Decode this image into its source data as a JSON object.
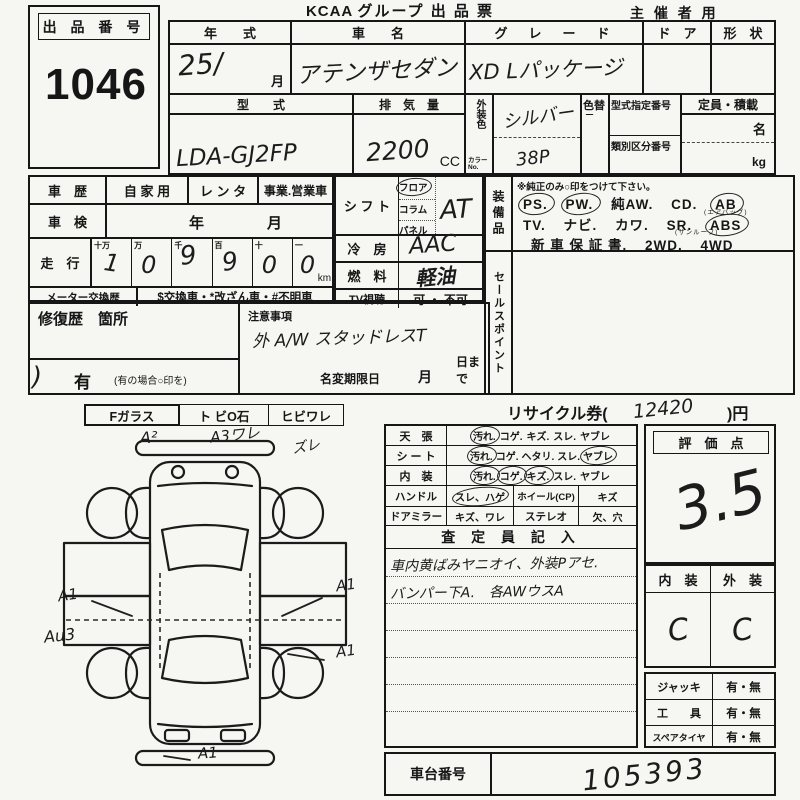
{
  "page": {
    "brand": "KCAA",
    "title": "グループ 出 品 票",
    "organizer": "主 催 者 用"
  },
  "lot": {
    "label": "出 品 番 号",
    "number": "1046"
  },
  "vehicle": {
    "year_label": "年　　式",
    "year_value": "25/",
    "month_label": "月",
    "name_label": "車　　名",
    "name_value": "アテンザセダン",
    "grade_label": "グ　レ　ー　ド",
    "grade_value": "XD Lパッケージ",
    "door_label": "ド　ア",
    "shape_label": "形　状",
    "model_label": "型　　式",
    "model_value": "LDA-GJ2FP",
    "disp_label": "排　気　量",
    "disp_value": "2200",
    "disp_unit": "CC",
    "color_label": "外装色",
    "color_no_label": "カラーNo.",
    "color_value": "シルバー",
    "color_no_value": "38P",
    "recolor_label": "色替",
    "cert_label": "型式指定番号",
    "class_label": "類別区分番号",
    "capacity_label": "定員・積載",
    "capacity_person": "名",
    "capacity_kg": "kg"
  },
  "history": {
    "label": "車　歴",
    "private": "自 家 用",
    "rental": "レ ン タ",
    "business": "事業.営業車",
    "inspection_label": "車　検",
    "inspection_year": "年",
    "inspection_month": "月",
    "mileage_label": "走　行",
    "digit_labels": [
      "十万",
      "万",
      "千",
      "百",
      "十",
      "一"
    ],
    "digits": [
      "1",
      "0",
      "9",
      "9",
      "0",
      "0"
    ],
    "unit": "km",
    "meter_label": "メーター交換歴",
    "meter_note": "$交換車・*改ざん車・#不明車"
  },
  "controls": {
    "shift_label": "シ フ ト",
    "shift_opts": [
      "フロア",
      "コラム",
      "パネル"
    ],
    "shift_value": "AT",
    "ac_label": "冷　房",
    "ac_value": "AAC",
    "fuel_label": "燃　料",
    "fuel_value": "軽油",
    "tv_label": "TV視聴",
    "tv_value": "可 ・ 不可"
  },
  "equipment": {
    "label": "装備品",
    "note": "※純正のみ○印をつけて下さい。",
    "l1": [
      "PS.",
      "PW.",
      "純AW.",
      "CD.",
      "AB"
    ],
    "ab_note": "(エアバッグ)",
    "l2": [
      "TV.",
      "ナビ.",
      "カワ.",
      "SR.",
      "ABS"
    ],
    "sr_note": "(サンルーフ)",
    "l3": [
      "新 車 保 証 書.",
      "2WD.",
      "4WD"
    ]
  },
  "sales_point": {
    "label": "セールスポイント"
  },
  "repair": {
    "label": "修復歴　箇所",
    "has": "有",
    "has_note": "(有の場合○印を)",
    "arc": ")"
  },
  "caution": {
    "label": "注意事項",
    "value": "外 A/W スタッドレスT",
    "deadline_label": "名変期限日",
    "month": "月",
    "day": "日まで"
  },
  "recycle": {
    "pre": "リサイクル券(",
    "value": "12420",
    "post": ")円"
  },
  "glass": {
    "f": "Fガラス",
    "stone": "ト ビO石",
    "crack": "ヒビワレ"
  },
  "diagram": {
    "a2": "A²",
    "a3": "A3ワレ",
    "zure": "ズレ",
    "a1_left": "A1",
    "au3": "Au3",
    "a1_right": "A1",
    "a1_right2": "A1",
    "a1_bottom": "A1"
  },
  "condition": {
    "ceiling_label": "天　張",
    "ceiling": [
      "汚れ.",
      "コゲ.",
      "キズ.",
      "スレ.",
      "ヤブレ"
    ],
    "seat_label": "シ ー ト",
    "seat": [
      "汚れ.",
      "コゲ.",
      "ヘタリ.",
      "スレ.",
      "ヤブレ"
    ],
    "interior_label": "内　装",
    "interior": [
      "汚れ.",
      "コゲ.",
      "キズ.",
      "スレ.",
      "ヤブレ"
    ],
    "handle_label": "ハンドル",
    "handle": "スレ、ハゲ",
    "wheel_label": "ホイール(CP)",
    "wheel": "キズ",
    "mirror_label": "ドアミラー",
    "mirror": "キズ、ワレ",
    "stereo_label": "ステレオ",
    "stereo": "欠、穴",
    "inspector_label": "査 定 員 記 入",
    "note1": "車内黄ばみヤニオイ、外装Pアセ.",
    "note2": "バンパー下A.　各AWウスA"
  },
  "score": {
    "label": "評　価　点",
    "value": "3.5",
    "interior_label": "内　装",
    "exterior_label": "外　装",
    "interior_value": "C",
    "exterior_value": "C"
  },
  "accessories": {
    "jack_label": "ジャッキ",
    "jack": "有・無",
    "tool_label": "工　　具",
    "tool": "有・無",
    "spare_label": "スペアタイヤ",
    "spare": "有・無"
  },
  "chassis": {
    "label": "車台番号",
    "value": "105393"
  },
  "colors": {
    "ink": "#161616",
    "paper": "#f6f6f2",
    "handwriting": "#1c1c1c"
  }
}
